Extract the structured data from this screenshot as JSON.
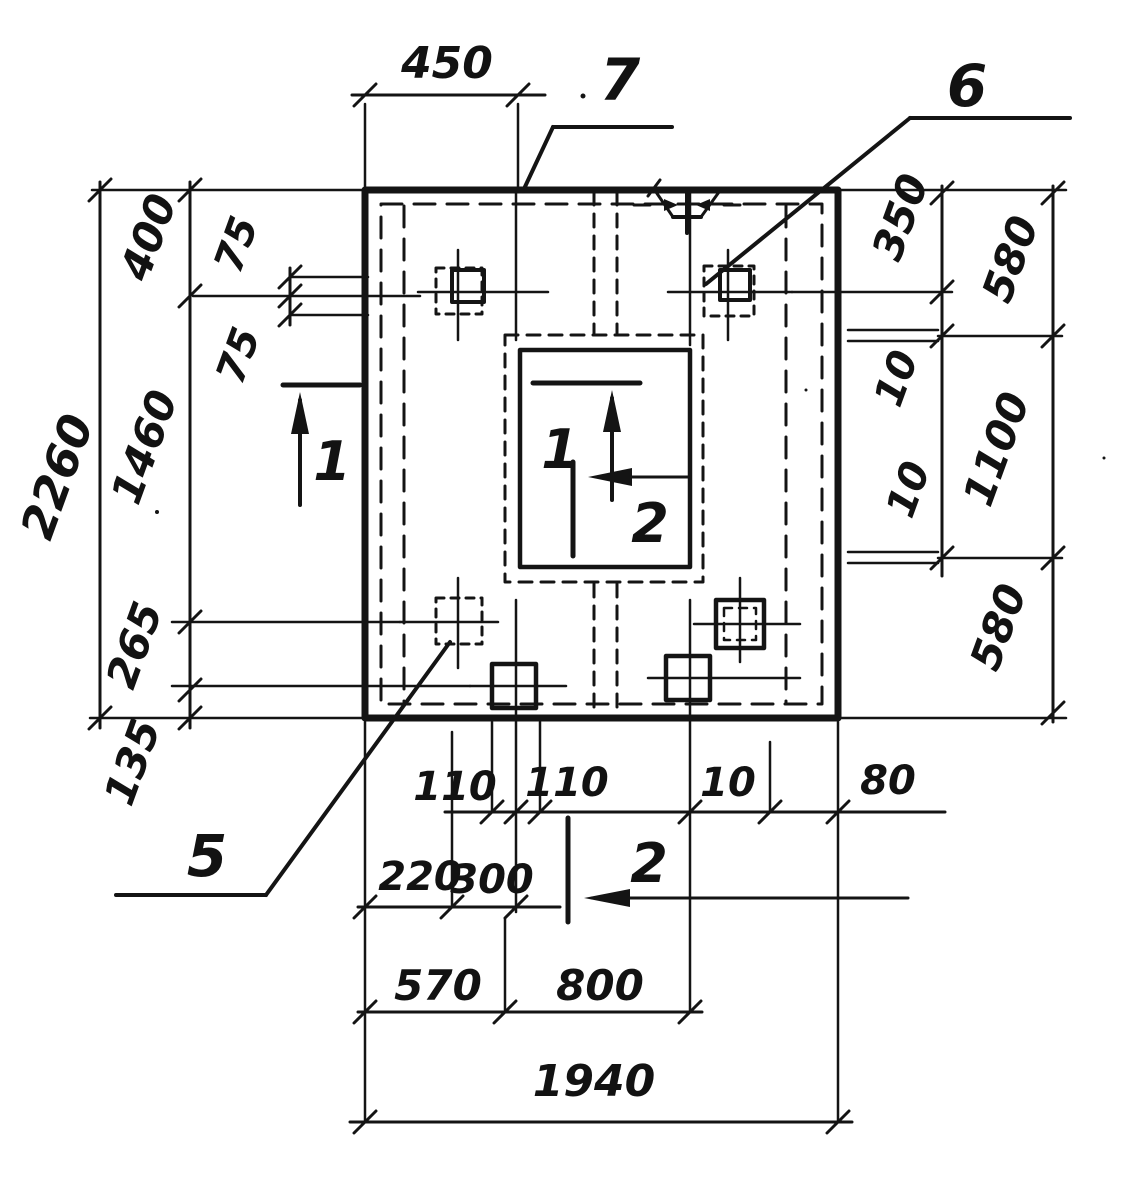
{
  "drawing": {
    "callouts": {
      "top": "7",
      "top_right": "6",
      "bottom_left": "5"
    },
    "sections": {
      "left_mark": "1",
      "opening_vertical_mark": "1",
      "opening_horizontal_mark": "2",
      "bottom_mark": "2"
    },
    "dimensions": {
      "top_width": "450",
      "left_total": "2260",
      "left_chain": [
        "400",
        "1460",
        "265",
        "135"
      ],
      "bolt_offsets_left": [
        "75",
        "75"
      ],
      "right_inner_chain": [
        "350",
        "10",
        "10"
      ],
      "right_outer_chain": [
        "580",
        "1100",
        "580"
      ],
      "bottom_bolt_row": [
        "110",
        "110",
        "10",
        "80"
      ],
      "bottom_inner_row": [
        "220",
        "300"
      ],
      "bottom_mid_row": [
        "570",
        "800"
      ],
      "bottom_total": "1940"
    }
  }
}
